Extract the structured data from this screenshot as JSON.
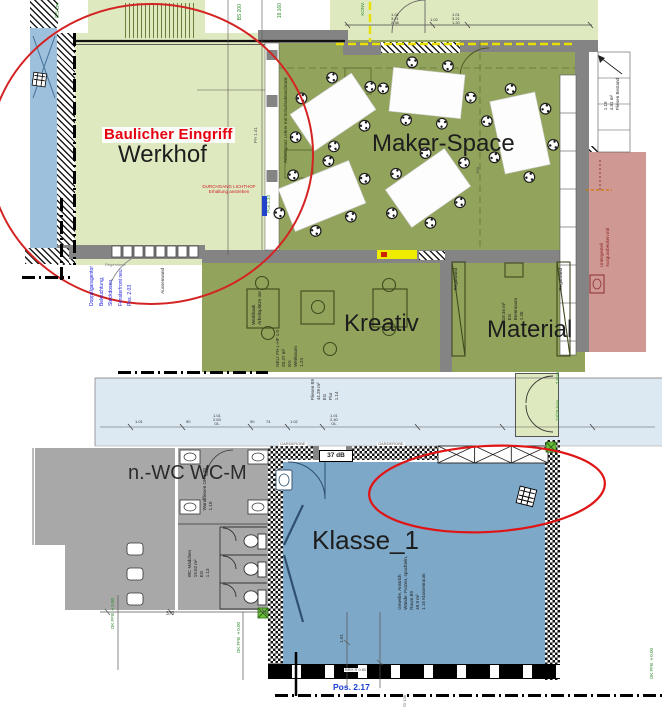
{
  "colors": {
    "pale_green": "#dfe9c0",
    "olive_green": "#92a45c",
    "wall_gray": "#848484",
    "wc_gray": "#a8a8a8",
    "klasse_blue": "#7ea8c7",
    "flur_blue": "#dce8f2",
    "window_blue": "#9dc1dc",
    "pink_room": "#d09892",
    "annotation_red": "#d42323",
    "highlight_yellow": "#f0ec00",
    "note_blue": "#1a1ae0",
    "note_green": "#2e8b2e"
  },
  "top_plan": {
    "rooms": {
      "werkhof": "Werkhof",
      "maker_space": "Maker-Space",
      "kreativ": "Kreativ",
      "material": "Material"
    },
    "annotations": {
      "baulicher_eingriff": "Baulicher Eingriff",
      "durchgang": "DURCHGANG LICHTHOF",
      "durchgang2": "Erhaltung anstreben",
      "teacher_desk": "Arbeitsplatz Lehrer mit Schubladenschrank",
      "corridor_no": "1.19",
      "corridor_area": "4.81 m²",
      "corridor_floor": "Fliesen Bestand",
      "ramp": "8.5 cm",
      "bs200": "BS 200",
      "dim18": "18.160",
      "konv": "KONV.",
      "ph": "PH 1.41",
      "pos233": "Pos 2.33",
      "regenrinne": "Regenrinne",
      "aussenwand": "Aussenwand",
      "dim300": "300",
      "regalwand": "Regalwand",
      "kreativ_info": [
        "1.24",
        "Werkraum",
        "EG",
        "83.37 m²",
        "NEU: FH L-HF 1.0"
      ],
      "material_info": [
        "1.26",
        "Brennraum",
        "EG",
        "18.46 m²"
      ],
      "pink_note": [
        "Ausgussbecken mit",
        "Untergestell"
      ],
      "werkbank": [
        "Arbeitsplätze 4er",
        "Werkbank"
      ],
      "blue_notes": [
        "Pos. 2.03",
        "Fensterfront neu",
        "Steckdosen,",
        "Beleuchtung,",
        "Doppelgaragentor"
      ],
      "top_dims_a": [
        "1.01",
        "3.21",
        "2.38"
      ],
      "top_dims_b": "1.02",
      "top_dims_c": [
        "1.01",
        "3.21",
        "1.20"
      ]
    }
  },
  "bottom_plan": {
    "rooms": {
      "wc_left": "n.-WC",
      "wc_m": "WC-M",
      "klasse": "Klasse_1"
    },
    "flur_info": [
      "1.14",
      "Flur",
      "EG",
      "44.28 m²",
      "Fliesen B9"
    ],
    "klasse_info": [
      "1.15 Klassenraum",
      "49.9 m²",
      "Raum B9",
      "Wände: Putzen, spachteln,",
      "Gewebe, Anstrich"
    ],
    "wc_info": [
      "1.13",
      "EG",
      "19.02 m²",
      "WC Mädchen"
    ],
    "wc_info2": [
      "1.10",
      "Wandfliesen OK 1.20"
    ],
    "garderobe": "GARDEROBE",
    "db": "37 dB",
    "dim370": "370",
    "dim181": "1.81",
    "brh": "BRH R 0.80",
    "pos217": "Pos. 2.17",
    "td": "TD 136",
    "green_a": "7.5cm",
    "green_b": "24/29.5cm",
    "ok_ffb": "OK FFB ±0.00",
    "flur_dims": [
      "1.01",
      "90",
      "1.01",
      "2.63",
      "OL",
      "90",
      "74",
      "1.02",
      "1.01",
      "2.40",
      "OL"
    ]
  },
  "furniture": {
    "tables": [
      {
        "cx": 333,
        "cy": 112,
        "w": 74,
        "h": 44,
        "rot": -34
      },
      {
        "cx": 427,
        "cy": 93,
        "w": 72,
        "h": 44,
        "rot": 6
      },
      {
        "cx": 322,
        "cy": 196,
        "w": 76,
        "h": 46,
        "rot": -22
      },
      {
        "cx": 428,
        "cy": 188,
        "w": 72,
        "h": 46,
        "rot": -35
      },
      {
        "cx": 520,
        "cy": 133,
        "w": 74,
        "h": 46,
        "rot": 78
      }
    ]
  }
}
